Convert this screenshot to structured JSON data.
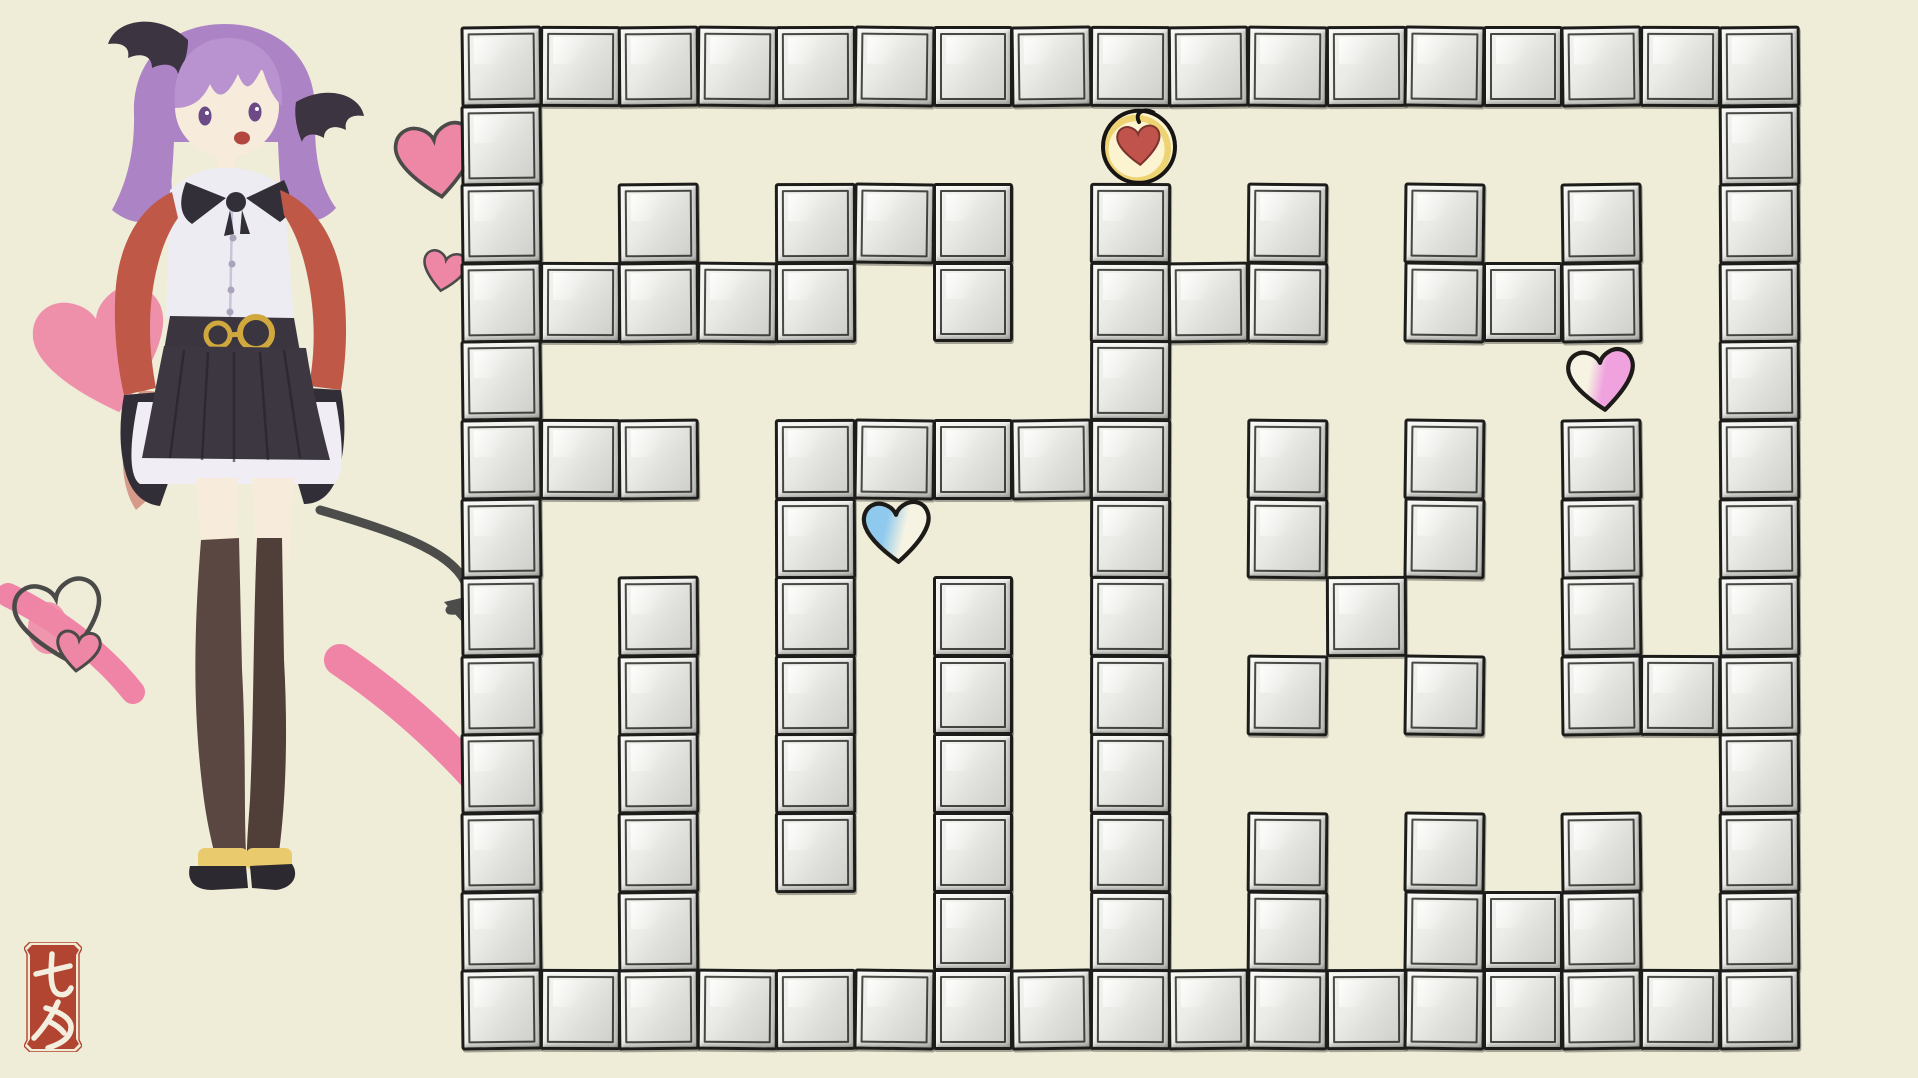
{
  "canvas": {
    "width": 1918,
    "height": 1078,
    "background": "#efecd8"
  },
  "decor": {
    "heart_fill": "#ee86a6",
    "heart_outline": "#4a4a48",
    "brush_stroke_color": "#ef84a7"
  },
  "character": {
    "label": "purple-haired succubus girl illustration",
    "colors": {
      "hair_back": "#ac84c6",
      "hair_front": "#b993cf",
      "wing": "#3c3440",
      "skin": "#f7ecdb",
      "eye": "#6b4a86",
      "mouth": "#b3473f",
      "shirt": "#edecf2",
      "placket": "#c9c3d6",
      "button": "#aaa3bb",
      "bow": "#332f39",
      "jacket": "#c05848",
      "sleeve": "#322e37",
      "belt": "#3a353f",
      "belt_gold": "#d0a83e",
      "skirt": "#3c3741",
      "pleat": "#232028",
      "frill": "#f0eef4",
      "stocking_left": "#5a4741",
      "stocking_right": "#503e39",
      "cuff": "#e9ca6c",
      "shoe": "#2c2931",
      "tail": "#4c4c4a",
      "back_heart": "#ee86a6"
    }
  },
  "stamp": {
    "text": "七夕",
    "bg_color": "#b24531",
    "stroke_color": "#f3eedd"
  },
  "maze": {
    "rows": 13,
    "cols": 17,
    "origin_x": 462,
    "origin_y": 27,
    "cell_size": 78.6,
    "block": {
      "border_color": "#1c1c1a",
      "face_light": "#f4f4f0",
      "face_dark": "#cccdc8"
    },
    "grid": [
      "11111111111111111",
      "10000000000000001",
      "10101110101010101",
      "11111010111011101",
      "10000000100000001",
      "11101111101010101",
      "10001000101010101",
      "10101010100100101",
      "10101010101010111",
      "10101010100000001",
      "10101010101010101",
      "10100010101011101",
      "11111111111111111"
    ],
    "tokens": [
      {
        "id": "player-token",
        "label": "red heart player token",
        "col": 8,
        "row": 1,
        "dx": 9,
        "dy": 1,
        "heart_fill": "#c0544d",
        "heart_stroke": "#7c332e",
        "circle_fill": "#fcf4d1",
        "ring_color": "#eccf68",
        "outline": "#171513"
      },
      {
        "id": "blue-heart",
        "label": "blue heart collectible",
        "col": 5,
        "row": 6,
        "dx": 3,
        "dy": -5,
        "fill_a": "#8fcaee",
        "fill_b": "#f6f3e2",
        "outline": "#1d1b18"
      },
      {
        "id": "pink-heart",
        "label": "pink heart collectible",
        "col": 14,
        "row": 4,
        "dx": 0,
        "dy": 0,
        "fill_a": "#f6f3e2",
        "fill_b": "#f0a2df",
        "outline": "#1d1b18"
      }
    ]
  }
}
